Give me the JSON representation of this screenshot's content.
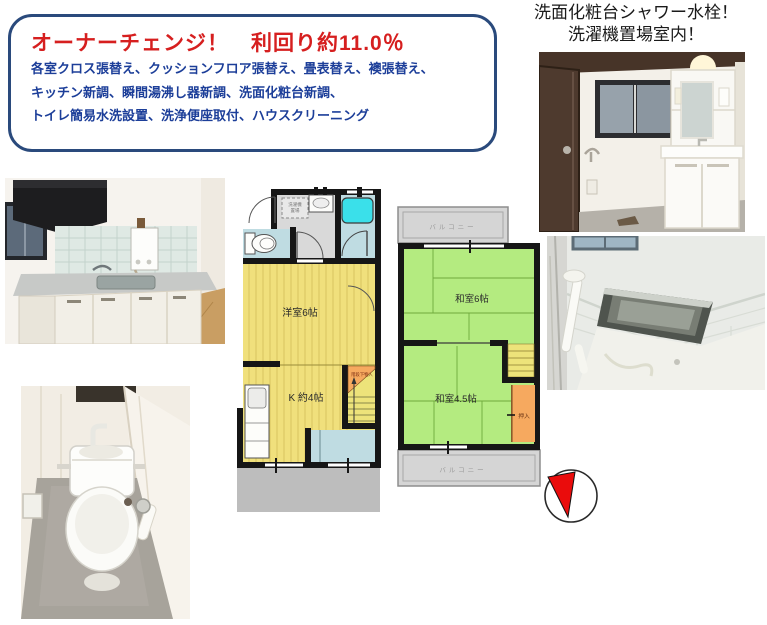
{
  "info_box": {
    "title": "オーナーチェンジ！　利回り約11.0％",
    "line1": "各室クロス張替え、クッションフロア張替え、畳表替え、襖張替え、",
    "line2": "キッチン新調、瞬間湯沸し器新調、洗面化粧台新調、",
    "line3": "トイレ簡易水洗設置、洗浄便座取付、ハウスクリーニング",
    "title_color": "#d61f1f",
    "body_color": "#1c3e99",
    "border_color": "#2a4a7c"
  },
  "headline": {
    "line1": "洗面化粧台シャワー水栓！",
    "line2": "洗濯機置場室内！"
  },
  "floorplan_1f": {
    "labels": {
      "laundry_line1": "洗濯機",
      "laundry_line2": "置場",
      "western_room": "洋室6帖",
      "kitchen": "K 約4帖",
      "under_stairs": "階段下物入"
    }
  },
  "floorplan_2f": {
    "labels": {
      "balcony_top": "バルコニー",
      "tatami_6": "和室6帖",
      "tatami_45": "和室4.5帖",
      "closet": "押入",
      "balcony_bottom": "バルコニー"
    }
  },
  "colors": {
    "flooring_yellow": "#f0e07c",
    "flooring_stripe": "#c9b44e",
    "tatami_green": "#b4eb80",
    "tatami_line": "#6faa3c",
    "bath_cyan": "#3ae0ea",
    "water_blue": "#bfdce2",
    "closet_orange": "#f6a95f",
    "stairs_yellow": "#ede37a",
    "balcony_gray": "#d5d5d5",
    "porch_gray": "#bdbdbd",
    "wall_black": "#161616",
    "compass_red": "#ea0c0c"
  }
}
